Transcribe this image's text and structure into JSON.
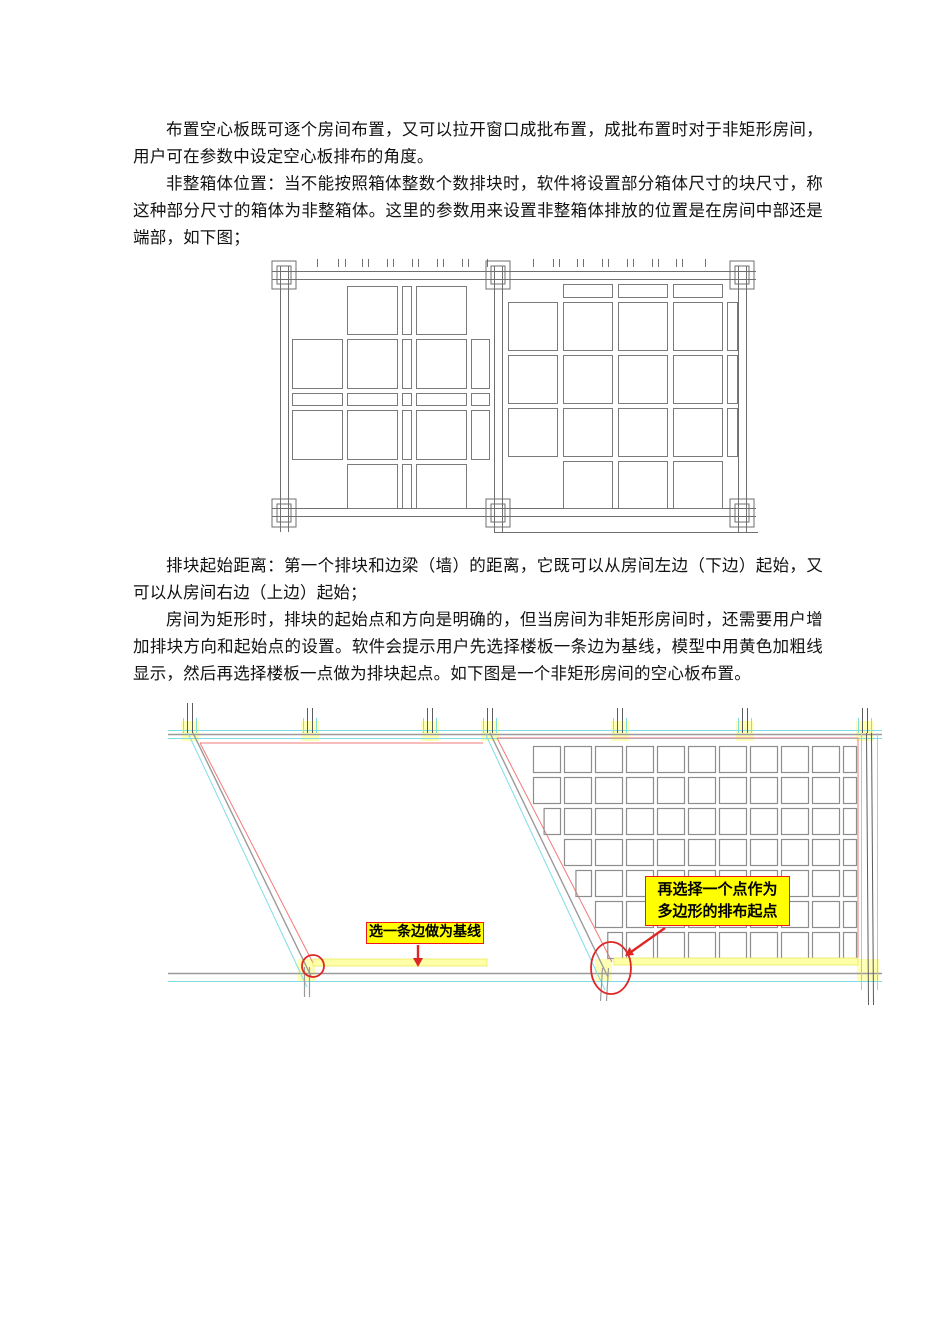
{
  "paragraphs": [
    "布置空心板既可逐个房间布置，又可以拉开窗口成批布置，成批布置时对于非矩形房间，用户可在参数中设定空心板排布的角度。",
    "非整箱体位置：当不能按照箱体整数个数排块时，软件将设置部分箱体尺寸的块尺寸，称这种部分尺寸的箱体为非整箱体。这里的参数用来设置非整箱体排放的位置是在房间中部还是端部，如下图；",
    "排块起始距离：第一个排块和边梁（墙）的距离，它既可以从房间左边（下边）起始，又可以从房间右边（上边）起始；",
    "房间为矩形时，排块的起始点和方向是明确的，但当房间为非矩形房间时，还需要用户增加排块方向和起始点的设置。软件会提示用户先选择楼板一条边为基线，模型中用黄色加粗线显示，然后再选择楼板一点做为排块起点。如下图是一个非矩形房间的空心板布置。"
  ],
  "figure1": {
    "stroke": "#6f6f6f",
    "cell_stroke": "#7a7a7a",
    "left_ticks": [
      49,
      70,
      77,
      94,
      100,
      119,
      125,
      144,
      150,
      169,
      175,
      194,
      200,
      219
    ],
    "right_ticks": [
      265,
      285,
      291,
      309,
      315,
      334,
      340,
      359,
      365,
      384,
      390,
      408,
      414,
      437
    ],
    "left_room": {
      "cols": [
        [
          24,
          50
        ],
        [
          79,
          50
        ],
        [
          134,
          9
        ],
        [
          148,
          50
        ],
        [
          203,
          18
        ]
      ],
      "rows": [
        [
          30,
          48
        ],
        [
          83,
          49
        ],
        [
          137,
          12
        ],
        [
          154,
          49
        ],
        [
          208,
          44
        ]
      ],
      "cells": [
        [
          1,
          2,
          3
        ],
        [
          0,
          1,
          2,
          3,
          4
        ],
        [
          0,
          1,
          2,
          3,
          4
        ],
        [
          0,
          1,
          2,
          3,
          4
        ],
        [
          1,
          2,
          3
        ]
      ]
    },
    "right_room": {
      "cols": [
        [
          240,
          49
        ],
        [
          295,
          49
        ],
        [
          350,
          49
        ],
        [
          405,
          49
        ],
        [
          459,
          10
        ]
      ],
      "rows": [
        [
          28,
          13
        ],
        [
          46,
          48
        ],
        [
          99,
          48
        ],
        [
          152,
          48
        ],
        [
          205,
          47
        ]
      ],
      "cells": [
        [
          1,
          2,
          3
        ],
        [
          0,
          1,
          2,
          3,
          4
        ],
        [
          0,
          1,
          2,
          3,
          4
        ],
        [
          0,
          1,
          2,
          3,
          4
        ],
        [
          1,
          2,
          3
        ]
      ]
    }
  },
  "figure2": {
    "colors": {
      "cyan": "#7fdde6",
      "gray": "#9a9a9a",
      "dark": "#5c5c5c",
      "red_line": "#f27a7a",
      "accent_red": "#e02525",
      "yellow_band": "#ffffa8",
      "yellow_edge": "#e8e860",
      "yellow_hl": "#ffffb4",
      "box_stroke": "#8d8d8d"
    },
    "callout1": {
      "text": "选一条边做为基线"
    },
    "callout2": {
      "line1": "再选择一个点作为",
      "line2": "多边形的排布起点"
    },
    "left_columns_x": [
      25,
      145,
      265
    ],
    "right_columns_x": [
      325,
      455,
      580,
      700
    ],
    "left_room": {
      "red_top": [
        35,
        318,
        43
      ],
      "slant_cyan": [
        23,
        33,
        142,
        287
      ],
      "slant_gray": [
        28,
        33,
        146,
        276
      ],
      "slant_red": [
        35,
        43,
        148,
        263
      ],
      "baseline": [
        148,
        259,
        174,
        7
      ],
      "circle": [
        148,
        266,
        11
      ]
    },
    "right_room": {
      "red_top_right": [
        332,
        38,
        693,
        258
      ],
      "slant_cyan": [
        320,
        33,
        440,
        290
      ],
      "slant_gray": [
        325,
        33,
        443,
        277
      ],
      "slant_red": [
        332,
        38,
        447,
        262
      ],
      "baseline": [
        449,
        258,
        244,
        7
      ],
      "ellipse": [
        446,
        268,
        20,
        26
      ],
      "grid": {
        "col_start": 368,
        "col_pitch": 31,
        "box_w": 27,
        "row_start": 46,
        "row_pitch": 31,
        "box_h": 26,
        "rows": 7,
        "right_clip": 691,
        "min_w": 6
      }
    }
  }
}
